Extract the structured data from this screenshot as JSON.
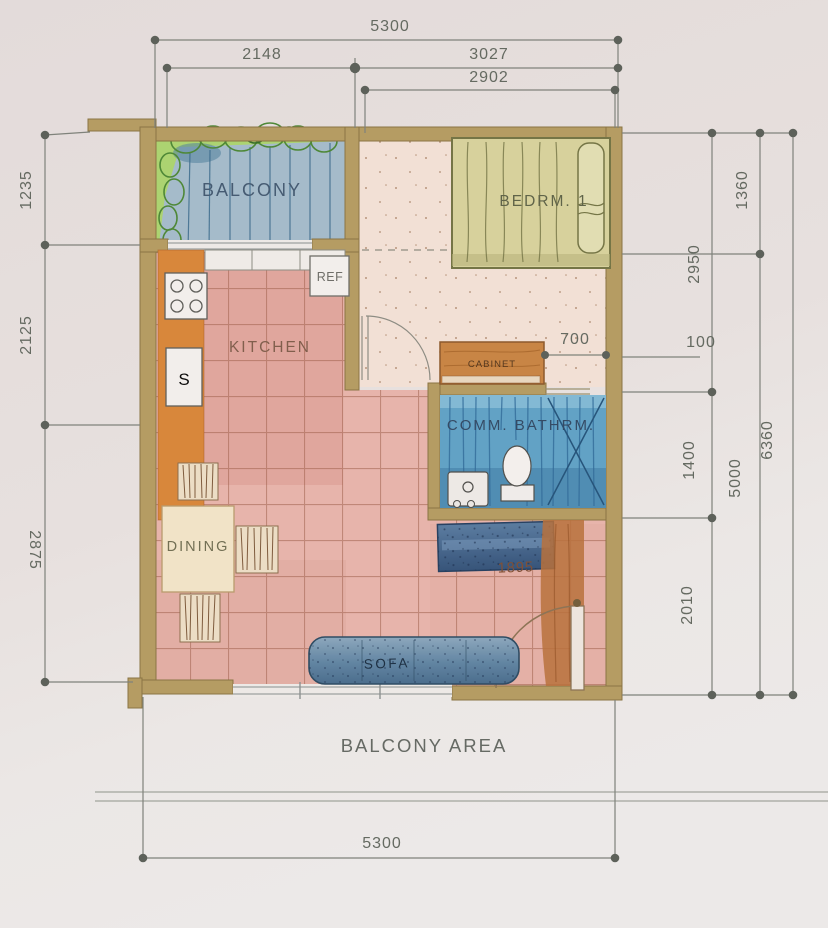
{
  "document": {
    "kind": "hand-rendered watercolor floor plan photo",
    "footer_label": "BALCONY AREA"
  },
  "labels": {
    "balcony": "BALCONY",
    "bedroom": "BEDRM. 1",
    "kitchen": "KITCHEN",
    "bathroom": "COMM. BATHRM.",
    "dining": "DINING",
    "sofa": "SOFA",
    "cabinet": "CABINET",
    "ref": "REF",
    "sink": "S",
    "balcony_area": "BALCONY AREA",
    "pencil_note": "1895"
  },
  "dims": {
    "top_overall": "5300",
    "top_left": "2148",
    "top_right": "3027",
    "top_inner": "2902",
    "left_top": "1235",
    "left_mid": "2125",
    "left_bottom": "2875",
    "right_balcony": "1360",
    "right_bedroom": "2950",
    "right_wall": "100",
    "right_overall": "6360",
    "right_bath": "1400",
    "right_main": "5000",
    "right_bottom": "2010",
    "door_opening": "700",
    "bottom_overall": "5300"
  },
  "colors": {
    "paper": "#e8e2e0",
    "wall_tan": "#b49b5e",
    "floor_pink": "#e9b4ab",
    "tile_line": "#9e5c46",
    "bedroom_floor": "#f5e3d7",
    "balcony_green": "#abd56d",
    "balcony_deck": "#a3bccb",
    "bathroom_blue": "#5ca1c6",
    "bed_olive": "#d8d39b",
    "cabinet_wood": "#c8823e",
    "counter_orange": "#d98434",
    "sofa_blue": "#4a7291",
    "dim_gray": "#5f655c"
  }
}
